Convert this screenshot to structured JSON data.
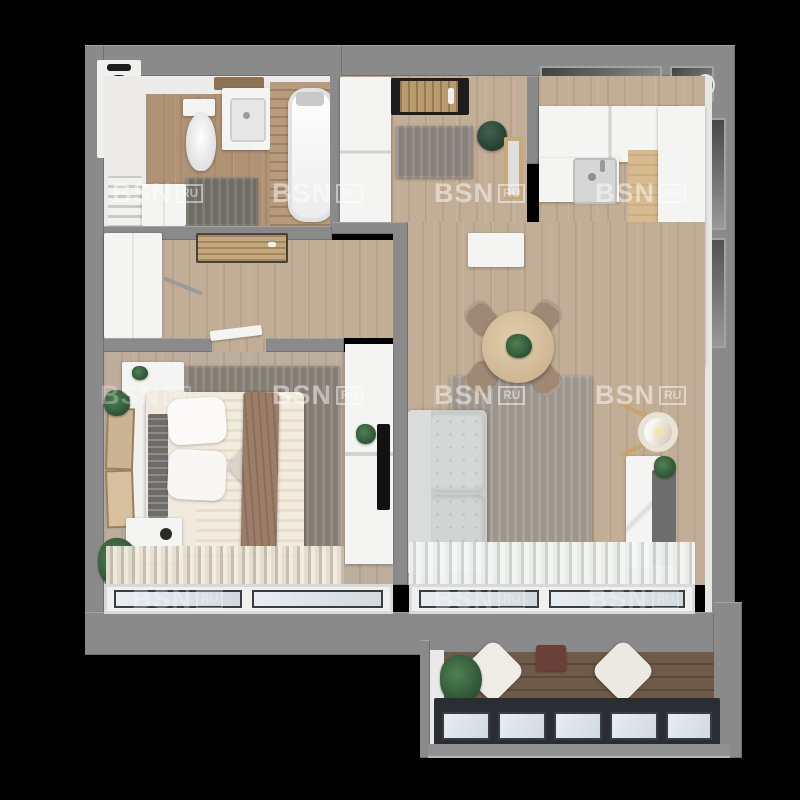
{
  "scene": {
    "title": "3D top-down floor plan render of a one-bedroom apartment",
    "type": "3d-floorplan-render",
    "background": "#000000"
  },
  "watermark": {
    "brand": "BSN",
    "suffix": "RU"
  },
  "palette": {
    "wall": "#8a8a8a",
    "floor_wood": "#c2ae96",
    "floor_bedroom": "#bdad9c",
    "floor_bathroom": "#b09275",
    "floor_balcony": "#6f5a49",
    "rug_living": "#a59d94",
    "rug_bedroom": "#8b847b",
    "rug_hall": "#8f8881",
    "sofa": "#d2d4d3",
    "bed_linen": "#f0eadd",
    "throw_blanket": "#9c7e68",
    "dining_chair": "#9f8874",
    "dining_table": "#d9c2a0",
    "pouf": "#2e4c3b",
    "plant": "#3c6b44",
    "cooktop": "#141414",
    "glazing_frame": "#2a2d31",
    "glass": "#dde5e8"
  },
  "rooms": [
    {
      "name": "bathroom",
      "furniture": [
        "toilet",
        "vanity-sink",
        "mirror-shelf",
        "bathtub",
        "towel-radiator",
        "cabinet",
        "bath-mat"
      ]
    },
    {
      "name": "entry-hall",
      "furniture": [
        "entrance-door",
        "wardrobe",
        "rug",
        "green-pouf",
        "wood-mirror"
      ]
    },
    {
      "name": "corridor",
      "furniture": [
        "wardrobe",
        "coat-rail",
        "bathroom-door"
      ]
    },
    {
      "name": "kitchen",
      "furniture": [
        "upper-cabinets",
        "sink",
        "wood-counter",
        "cooktop",
        "tall-cabinets"
      ]
    },
    {
      "name": "living-room",
      "furniture": [
        "sofa",
        "rug",
        "round-dining-table",
        "four-chairs",
        "table-plant",
        "floor-lamp",
        "tv-cabinet",
        "sideboard",
        "curtains",
        "window"
      ]
    },
    {
      "name": "bedroom",
      "furniture": [
        "double-bed",
        "slat-headboard",
        "pillows",
        "throw-blanket",
        "rug",
        "nightstands",
        "plants",
        "picture-frames",
        "wardrobe",
        "tv",
        "curtains",
        "window"
      ]
    },
    {
      "name": "balcony",
      "furniture": [
        "plant",
        "two-floor-cushions",
        "small-table",
        "panoramic-glazing"
      ]
    }
  ]
}
